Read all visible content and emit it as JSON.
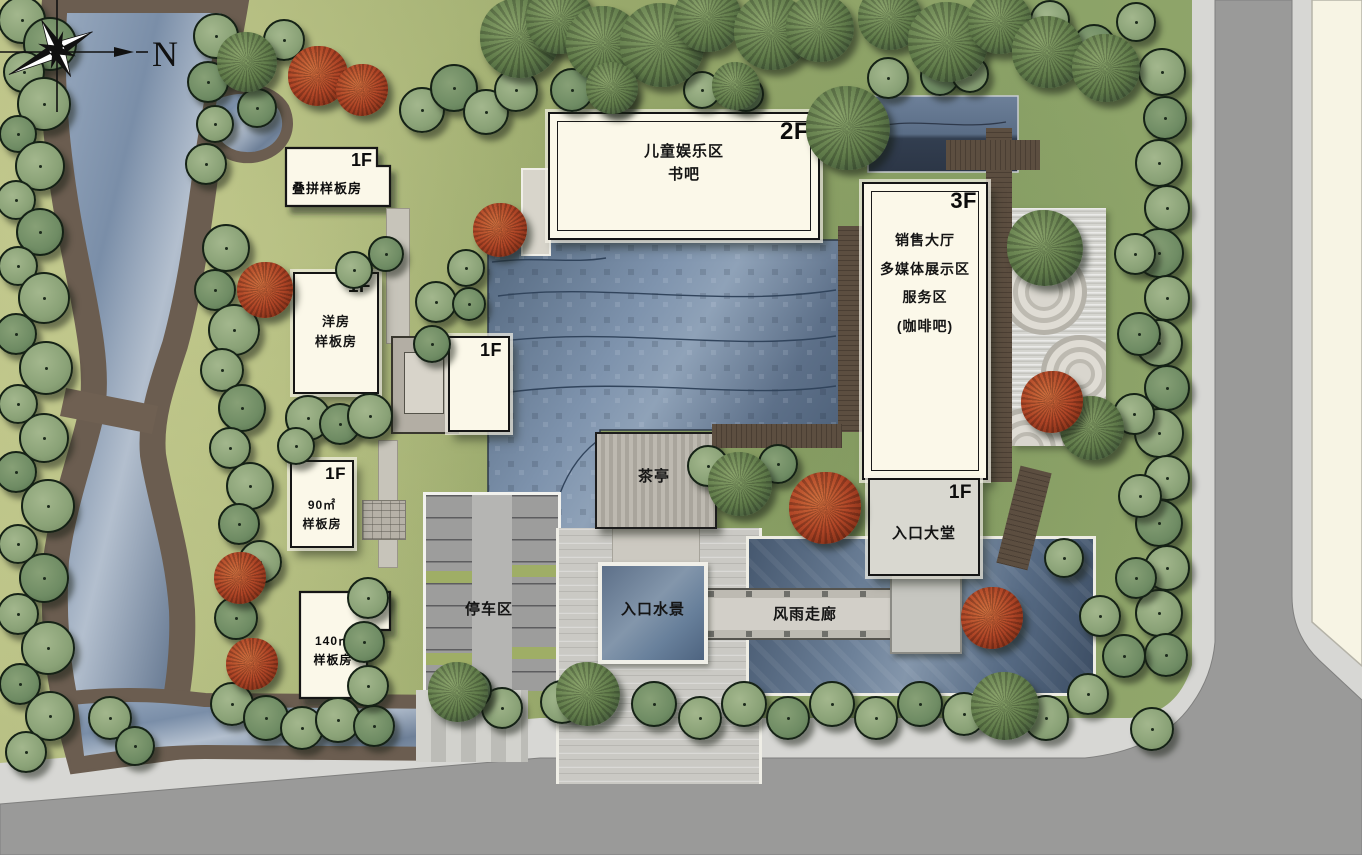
{
  "buildings": {
    "duplex": {
      "floor": "1F",
      "name": "叠拼样板房"
    },
    "terrace": {
      "floor": "1F",
      "name": "洋房\n样板房"
    },
    "small1f": {
      "floor": "1F"
    },
    "m90": {
      "floor": "1F",
      "name": "90㎡\n样板房"
    },
    "m140": {
      "floor": "1F",
      "name": "140㎡\n样板房"
    },
    "kids": {
      "floor": "2F",
      "name": "儿童娱乐区\n书吧"
    },
    "sales": {
      "floor": "3F",
      "name": "销售大厅\n多媒体展示区\n服务区\n(咖啡吧)"
    },
    "lobby": {
      "floor": "1F",
      "name": "入口大堂"
    }
  },
  "areas": {
    "parking": "停车区",
    "teahouse": "茶亭",
    "waterfeature": "入口水景",
    "corridor": "风雨走廊"
  },
  "compass": {
    "label": "N"
  },
  "colors": {
    "water": "#6d8199",
    "pond_dark": "#4d6078",
    "grass": "#9cab6d",
    "bank": "#6b5d50",
    "road": "#9a9a99",
    "sidewalk": "#d7d7d4",
    "parcel": "#f7f4e4",
    "building_fill": "#fbf8e9",
    "tree_green": "#8aa277",
    "tree_dark": "#6f8c64",
    "tree_red": "#b04526",
    "deck": "#5c4e40",
    "zen": "#d5d5d0"
  },
  "landscape": {
    "trees": [
      [
        20,
        18,
        22,
        0
      ],
      [
        48,
        42,
        25,
        1
      ],
      [
        22,
        70,
        19,
        0
      ],
      [
        42,
        102,
        25,
        0
      ],
      [
        16,
        132,
        17,
        1
      ],
      [
        38,
        164,
        23,
        0
      ],
      [
        14,
        198,
        18,
        0
      ],
      [
        38,
        230,
        22,
        1
      ],
      [
        16,
        264,
        18,
        0
      ],
      [
        42,
        296,
        24,
        0
      ],
      [
        14,
        332,
        19,
        1
      ],
      [
        44,
        366,
        25,
        0
      ],
      [
        16,
        402,
        18,
        0
      ],
      [
        42,
        436,
        23,
        0
      ],
      [
        14,
        470,
        19,
        1
      ],
      [
        46,
        504,
        25,
        0
      ],
      [
        16,
        542,
        18,
        0
      ],
      [
        42,
        576,
        23,
        1
      ],
      [
        16,
        612,
        19,
        0
      ],
      [
        46,
        646,
        25,
        0
      ],
      [
        18,
        682,
        19,
        1
      ],
      [
        48,
        714,
        23,
        0
      ],
      [
        24,
        750,
        19,
        0
      ],
      [
        108,
        716,
        20,
        0
      ],
      [
        133,
        744,
        18,
        1
      ],
      [
        214,
        34,
        21,
        0
      ],
      [
        206,
        80,
        19,
        1
      ],
      [
        213,
        122,
        17,
        0
      ],
      [
        204,
        162,
        19,
        0
      ],
      [
        224,
        246,
        22,
        0
      ],
      [
        213,
        288,
        19,
        1
      ],
      [
        232,
        328,
        24,
        0
      ],
      [
        220,
        368,
        20,
        0
      ],
      [
        240,
        406,
        22,
        1
      ],
      [
        228,
        446,
        19,
        0
      ],
      [
        248,
        484,
        22,
        0
      ],
      [
        237,
        522,
        19,
        1
      ],
      [
        258,
        560,
        20,
        0
      ],
      [
        234,
        616,
        20,
        1
      ],
      [
        230,
        702,
        20,
        0
      ],
      [
        264,
        716,
        21,
        1
      ],
      [
        300,
        726,
        20,
        0
      ],
      [
        336,
        718,
        21,
        0
      ],
      [
        372,
        724,
        19,
        1
      ],
      [
        282,
        38,
        19,
        0
      ],
      [
        255,
        106,
        18,
        1
      ],
      [
        352,
        268,
        17,
        0
      ],
      [
        384,
        252,
        16,
        1
      ],
      [
        420,
        108,
        21,
        0
      ],
      [
        452,
        86,
        22,
        1
      ],
      [
        484,
        110,
        21,
        0
      ],
      [
        514,
        88,
        20,
        0
      ],
      [
        570,
        88,
        20,
        1
      ],
      [
        612,
        92,
        18,
        0
      ],
      [
        700,
        88,
        17,
        0
      ],
      [
        744,
        92,
        16,
        1
      ],
      [
        886,
        76,
        19,
        0
      ],
      [
        938,
        74,
        18,
        1
      ],
      [
        968,
        72,
        17,
        0
      ],
      [
        1048,
        18,
        18,
        0
      ],
      [
        1092,
        44,
        20,
        1
      ],
      [
        1134,
        20,
        18,
        0
      ],
      [
        1160,
        70,
        22,
        0
      ],
      [
        1163,
        116,
        20,
        1
      ],
      [
        1157,
        161,
        22,
        0
      ],
      [
        1165,
        206,
        21,
        0
      ],
      [
        1157,
        251,
        23,
        1
      ],
      [
        1165,
        296,
        21,
        0
      ],
      [
        1157,
        341,
        22,
        0
      ],
      [
        1165,
        386,
        21,
        1
      ],
      [
        1157,
        431,
        23,
        0
      ],
      [
        1165,
        476,
        21,
        0
      ],
      [
        1157,
        521,
        22,
        1
      ],
      [
        1165,
        566,
        21,
        0
      ],
      [
        1157,
        611,
        22,
        0
      ],
      [
        1164,
        653,
        20,
        1
      ],
      [
        1150,
        727,
        20,
        0
      ],
      [
        1133,
        252,
        19,
        0
      ],
      [
        1137,
        332,
        20,
        1
      ],
      [
        1132,
        412,
        19,
        0
      ],
      [
        1138,
        494,
        20,
        0
      ],
      [
        1134,
        576,
        19,
        1
      ],
      [
        1098,
        614,
        19,
        0
      ],
      [
        1122,
        654,
        20,
        1
      ],
      [
        1086,
        692,
        19,
        0
      ],
      [
        560,
        700,
        20,
        0
      ],
      [
        652,
        702,
        21,
        1
      ],
      [
        698,
        716,
        20,
        0
      ],
      [
        742,
        702,
        21,
        0
      ],
      [
        786,
        716,
        20,
        1
      ],
      [
        830,
        702,
        21,
        0
      ],
      [
        874,
        716,
        20,
        0
      ],
      [
        918,
        702,
        21,
        1
      ],
      [
        962,
        712,
        20,
        0
      ],
      [
        1044,
        716,
        21,
        0
      ],
      [
        500,
        706,
        19,
        0
      ],
      [
        470,
        688,
        18,
        1
      ],
      [
        434,
        300,
        19,
        0
      ],
      [
        430,
        342,
        17,
        1
      ],
      [
        306,
        416,
        21,
        0
      ],
      [
        338,
        422,
        19,
        1
      ],
      [
        368,
        414,
        21,
        0
      ],
      [
        294,
        444,
        17,
        0
      ],
      [
        464,
        266,
        17,
        0
      ],
      [
        467,
        302,
        15,
        1
      ],
      [
        366,
        596,
        19,
        0
      ],
      [
        362,
        640,
        19,
        1
      ],
      [
        366,
        684,
        19,
        0
      ],
      [
        706,
        464,
        19,
        0
      ],
      [
        776,
        462,
        18,
        1
      ],
      [
        1062,
        556,
        18,
        0
      ]
    ],
    "canopy_trees": [
      [
        247,
        62,
        30
      ],
      [
        520,
        38,
        40
      ],
      [
        560,
        20,
        34
      ],
      [
        604,
        44,
        38
      ],
      [
        662,
        45,
        42
      ],
      [
        708,
        18,
        34
      ],
      [
        772,
        32,
        38
      ],
      [
        820,
        28,
        34
      ],
      [
        890,
        18,
        32
      ],
      [
        948,
        42,
        40
      ],
      [
        1000,
        22,
        32
      ],
      [
        1048,
        52,
        36
      ],
      [
        1106,
        68,
        34
      ],
      [
        848,
        128,
        42
      ],
      [
        1045,
        248,
        38
      ],
      [
        740,
        484,
        32
      ],
      [
        1092,
        428,
        32
      ],
      [
        588,
        694,
        32
      ],
      [
        1005,
        706,
        34
      ],
      [
        458,
        692,
        30
      ],
      [
        612,
        88,
        26
      ],
      [
        736,
        86,
        24
      ]
    ],
    "red_trees": [
      [
        318,
        76,
        30
      ],
      [
        362,
        90,
        26
      ],
      [
        500,
        230,
        27
      ],
      [
        265,
        290,
        28
      ],
      [
        240,
        578,
        26
      ],
      [
        252,
        664,
        26
      ],
      [
        825,
        508,
        36
      ],
      [
        992,
        618,
        31
      ],
      [
        1052,
        402,
        31
      ]
    ]
  }
}
